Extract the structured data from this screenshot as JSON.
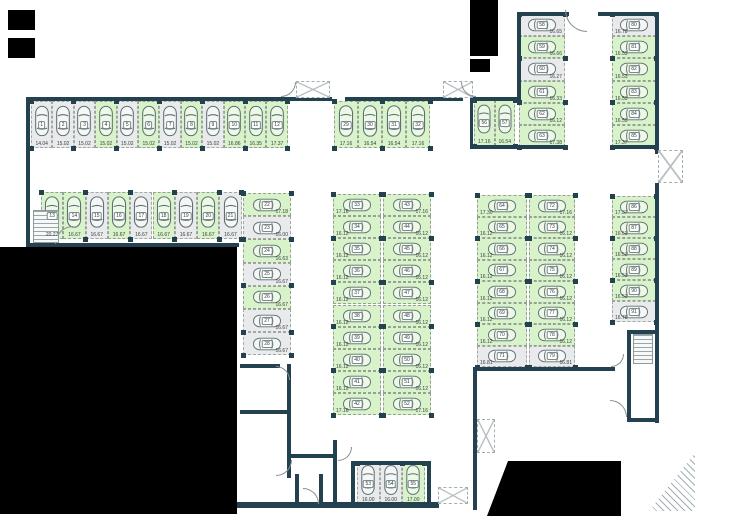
{
  "plan": {
    "title": "parking-garage-floor-plan",
    "colors": {
      "wall": "#24414f",
      "free": "#d8f2ca",
      "occupied": "#e9eaeb",
      "dash": "#97a097",
      "car_outline": "#5f6f72",
      "mask": "#000000"
    },
    "canvas": {
      "w": 754,
      "h": 522
    },
    "groups": [
      {
        "id": "row-01-12",
        "dir": "row",
        "x": 31,
        "y": 101,
        "sw": 21.4,
        "sh": 47,
        "areaPos": "center",
        "spaces": [
          {
            "n": "1",
            "area": "14.04",
            "state": "occupied"
          },
          {
            "n": "2",
            "area": "15.02",
            "state": "occupied"
          },
          {
            "n": "3",
            "area": "15.02",
            "state": "occupied"
          },
          {
            "n": "4",
            "area": "15.02",
            "state": "free"
          },
          {
            "n": "5",
            "area": "15.02",
            "state": "occupied"
          },
          {
            "n": "6",
            "area": "15.02",
            "state": "free"
          },
          {
            "n": "7",
            "area": "15.02",
            "state": "occupied"
          },
          {
            "n": "8",
            "area": "15.02",
            "state": "free"
          },
          {
            "n": "9",
            "area": "15.02",
            "state": "occupied"
          },
          {
            "n": "10",
            "area": "16.86",
            "state": "free"
          },
          {
            "n": "11",
            "area": "16.35",
            "state": "free"
          },
          {
            "n": "12",
            "area": "17.37",
            "state": "free"
          }
        ]
      },
      {
        "id": "row-13-21",
        "dir": "row",
        "x": 41,
        "y": 192,
        "sw": 22.3,
        "sh": 47,
        "areaPos": "center",
        "spaces": [
          {
            "n": "13",
            "area": "20.27",
            "state": "free"
          },
          {
            "n": "14",
            "area": "16.67",
            "state": "free"
          },
          {
            "n": "15",
            "area": "16.67",
            "state": "occupied"
          },
          {
            "n": "16",
            "area": "16.67",
            "state": "free"
          },
          {
            "n": "17",
            "area": "16.67",
            "state": "occupied"
          },
          {
            "n": "18",
            "area": "16.67",
            "state": "free"
          },
          {
            "n": "19",
            "area": "16.67",
            "state": "occupied"
          },
          {
            "n": "20",
            "area": "16.67",
            "state": "free"
          },
          {
            "n": "21",
            "area": "16.67",
            "state": "occupied"
          }
        ]
      },
      {
        "id": "col-22-28",
        "dir": "col",
        "x": 243,
        "y": 193,
        "sw": 48,
        "sh": 23.2,
        "areaPos": "right",
        "spaces": [
          {
            "n": "22",
            "area": "17.18",
            "state": "free"
          },
          {
            "n": "23",
            "area": "16.00",
            "state": "occupied"
          },
          {
            "n": "24",
            "area": "16.63",
            "state": "free"
          },
          {
            "n": "25",
            "area": "16.67",
            "state": "occupied"
          },
          {
            "n": "26",
            "area": "16.67",
            "state": "free"
          },
          {
            "n": "27",
            "area": "16.67",
            "state": "occupied"
          },
          {
            "n": "28",
            "area": "16.67",
            "state": "occupied"
          }
        ]
      },
      {
        "id": "row-29-32",
        "dir": "row",
        "x": 334,
        "y": 101,
        "sw": 24,
        "sh": 47,
        "areaPos": "center",
        "spaces": [
          {
            "n": "29",
            "area": "17.16",
            "state": "free"
          },
          {
            "n": "30",
            "area": "16.54",
            "state": "free"
          },
          {
            "n": "31",
            "area": "16.54",
            "state": "free"
          },
          {
            "n": "32",
            "area": "17.16",
            "state": "free"
          }
        ]
      },
      {
        "id": "col-33-42",
        "dir": "col",
        "x": 333,
        "y": 194,
        "sw": 48,
        "sh": 22.1,
        "areaPos": "left",
        "spaces": [
          {
            "n": "33",
            "area": "17.16",
            "state": "free"
          },
          {
            "n": "34",
            "area": "16.12",
            "state": "free"
          },
          {
            "n": "35",
            "area": "16.12",
            "state": "free"
          },
          {
            "n": "36",
            "area": "16.12",
            "state": "free"
          },
          {
            "n": "37",
            "area": "16.12",
            "state": "free"
          },
          {
            "n": "38",
            "area": "16.12",
            "state": "free"
          },
          {
            "n": "39",
            "area": "16.12",
            "state": "free"
          },
          {
            "n": "40",
            "area": "16.12",
            "state": "free"
          },
          {
            "n": "41",
            "area": "16.12",
            "state": "free"
          },
          {
            "n": "42",
            "area": "17.16",
            "state": "free"
          }
        ]
      },
      {
        "id": "col-43-52",
        "dir": "col",
        "x": 383,
        "y": 194,
        "sw": 48,
        "sh": 22.1,
        "areaPos": "right",
        "spaces": [
          {
            "n": "43",
            "area": "17.16",
            "state": "free"
          },
          {
            "n": "44",
            "area": "16.12",
            "state": "free"
          },
          {
            "n": "45",
            "area": "16.12",
            "state": "free"
          },
          {
            "n": "46",
            "area": "16.12",
            "state": "free"
          },
          {
            "n": "47",
            "area": "16.12",
            "state": "free"
          },
          {
            "n": "48",
            "area": "16.12",
            "state": "free"
          },
          {
            "n": "49",
            "area": "16.12",
            "state": "free"
          },
          {
            "n": "50",
            "area": "16.12",
            "state": "free"
          },
          {
            "n": "51",
            "area": "16.12",
            "state": "free"
          },
          {
            "n": "52",
            "area": "17.16",
            "state": "free"
          }
        ]
      },
      {
        "id": "row-53-55",
        "dir": "row",
        "x": 357,
        "y": 463,
        "sw": 22.5,
        "sh": 41,
        "areaPos": "center",
        "spaces": [
          {
            "n": "53",
            "area": "16.00",
            "state": "occupied"
          },
          {
            "n": "54",
            "area": "16.00",
            "state": "occupied"
          },
          {
            "n": "55",
            "area": "17.00",
            "state": "free"
          }
        ]
      },
      {
        "id": "row-56-57",
        "dir": "row",
        "x": 474,
        "y": 100,
        "sw": 20.5,
        "sh": 46,
        "areaPos": "center",
        "spaces": [
          {
            "n": "56",
            "area": "17.16",
            "state": "free"
          },
          {
            "n": "57",
            "area": "16.54",
            "state": "free"
          }
        ]
      },
      {
        "id": "col-58-63",
        "dir": "col",
        "x": 519,
        "y": 14,
        "sw": 46,
        "sh": 22.2,
        "areaPos": "right",
        "spaces": [
          {
            "n": "58",
            "area": "16.65",
            "state": "occupied"
          },
          {
            "n": "59",
            "area": "16.66",
            "state": "free"
          },
          {
            "n": "60",
            "area": "16.27",
            "state": "occupied"
          },
          {
            "n": "61",
            "area": "16.33",
            "state": "free"
          },
          {
            "n": "62",
            "area": "16.12",
            "state": "free"
          },
          {
            "n": "63",
            "area": "17.38",
            "state": "free"
          }
        ]
      },
      {
        "id": "col-80-85",
        "dir": "col",
        "x": 612,
        "y": 14,
        "sw": 44,
        "sh": 22.2,
        "areaPos": "left",
        "spaces": [
          {
            "n": "80",
            "area": "16.78",
            "state": "occupied"
          },
          {
            "n": "81",
            "area": "16.53",
            "state": "free"
          },
          {
            "n": "82",
            "area": "16.53",
            "state": "free"
          },
          {
            "n": "83",
            "area": "16.53",
            "state": "free"
          },
          {
            "n": "84",
            "area": "16.53",
            "state": "free"
          },
          {
            "n": "85",
            "area": "17.37",
            "state": "free"
          }
        ]
      },
      {
        "id": "col-64-71",
        "dir": "col",
        "x": 477,
        "y": 195,
        "sw": 50,
        "sh": 21.5,
        "areaPos": "left",
        "spaces": [
          {
            "n": "64",
            "area": "17.30",
            "state": "free"
          },
          {
            "n": "65",
            "area": "16.12",
            "state": "free"
          },
          {
            "n": "66",
            "area": "16.12",
            "state": "free"
          },
          {
            "n": "67",
            "area": "16.12",
            "state": "free"
          },
          {
            "n": "68",
            "area": "16.12",
            "state": "free"
          },
          {
            "n": "69",
            "area": "16.12",
            "state": "free"
          },
          {
            "n": "70",
            "area": "16.12",
            "state": "free"
          },
          {
            "n": "71",
            "area": "16.81",
            "state": "occupied"
          }
        ]
      },
      {
        "id": "col-72-79",
        "dir": "col",
        "x": 529,
        "y": 195,
        "sw": 46,
        "sh": 21.5,
        "areaPos": "right",
        "spaces": [
          {
            "n": "72",
            "area": "17.16",
            "state": "free"
          },
          {
            "n": "73",
            "area": "16.12",
            "state": "free"
          },
          {
            "n": "74",
            "area": "16.12",
            "state": "free"
          },
          {
            "n": "75",
            "area": "16.12",
            "state": "free"
          },
          {
            "n": "76",
            "area": "16.12",
            "state": "free"
          },
          {
            "n": "77",
            "area": "16.12",
            "state": "free"
          },
          {
            "n": "78",
            "area": "16.12",
            "state": "free"
          },
          {
            "n": "79",
            "area": "16.81",
            "state": "occupied"
          }
        ]
      },
      {
        "id": "col-86-91",
        "dir": "col",
        "x": 612,
        "y": 196,
        "sw": 44,
        "sh": 21,
        "areaPos": "left",
        "spaces": [
          {
            "n": "86",
            "area": "17.37",
            "state": "free"
          },
          {
            "n": "87",
            "area": "16.53",
            "state": "free"
          },
          {
            "n": "88",
            "area": "16.53",
            "state": "free"
          },
          {
            "n": "89",
            "area": "16.53",
            "state": "free"
          },
          {
            "n": "90",
            "area": "16.53",
            "state": "free"
          },
          {
            "n": "91",
            "area": "16.78",
            "state": "occupied"
          }
        ]
      }
    ],
    "walls": [
      [
        26,
        97,
        306,
        4
      ],
      [
        345,
        97,
        118,
        4
      ],
      [
        26,
        97,
        4,
        150
      ],
      [
        26,
        243,
        213,
        4
      ],
      [
        470,
        97,
        51,
        4
      ],
      [
        470,
        97,
        3,
        52
      ],
      [
        470,
        145,
        51,
        4
      ],
      [
        517,
        12,
        4,
        90
      ],
      [
        517,
        12,
        52,
        4
      ],
      [
        598,
        12,
        61,
        4
      ],
      [
        655,
        12,
        4,
        142
      ],
      [
        517,
        145,
        50,
        4
      ],
      [
        611,
        145,
        48,
        4
      ],
      [
        655,
        183,
        4,
        240
      ],
      [
        473,
        367,
        142,
        4
      ],
      [
        473,
        367,
        4,
        143
      ],
      [
        627,
        330,
        4,
        92
      ],
      [
        627,
        330,
        32,
        4
      ],
      [
        627,
        418,
        32,
        4
      ],
      [
        333,
        440,
        4,
        68
      ],
      [
        351,
        461,
        80,
        4
      ],
      [
        351,
        461,
        4,
        46
      ],
      [
        427,
        461,
        4,
        46
      ],
      [
        337,
        502,
        102,
        6
      ],
      [
        240,
        364,
        40,
        4
      ],
      [
        240,
        410,
        51,
        4
      ],
      [
        287,
        364,
        4,
        114
      ],
      [
        287,
        454,
        46,
        4
      ],
      [
        295,
        474,
        4,
        30
      ],
      [
        319,
        474,
        4,
        30
      ],
      [
        237,
        502,
        100,
        6
      ]
    ],
    "vents": [
      [
        296,
        81,
        34,
        17
      ],
      [
        443,
        81,
        30,
        17
      ],
      [
        658,
        150,
        25,
        33
      ],
      [
        477,
        419,
        18,
        34
      ],
      [
        438,
        487,
        30,
        17
      ]
    ],
    "doors": [
      [
        281,
        82,
        15,
        "br"
      ],
      [
        461,
        82,
        15,
        "bl"
      ],
      [
        565,
        10,
        22,
        "bl"
      ],
      [
        55,
        226,
        18,
        "tl"
      ],
      [
        276,
        366,
        14,
        "tr"
      ],
      [
        276,
        460,
        16,
        "br"
      ],
      [
        303,
        488,
        16,
        "tr"
      ],
      [
        338,
        447,
        14,
        "br"
      ],
      [
        610,
        400,
        17,
        "tr"
      ],
      [
        611,
        354,
        13,
        "br"
      ]
    ],
    "stairs": [
      [
        33,
        210,
        26,
        33
      ],
      [
        633,
        334,
        20,
        30
      ]
    ],
    "hatches": [
      [
        649,
        453,
        46,
        58
      ]
    ],
    "masks": {
      "rects": [
        [
          0,
          247,
          237,
          267
        ],
        [
          8,
          10,
          27,
          20
        ],
        [
          8,
          38,
          27,
          20
        ],
        [
          470,
          0,
          28,
          56
        ],
        [
          470,
          59,
          20,
          13
        ]
      ],
      "polys": [
        "polygon(508px 461px, 621px 461px, 621px 516px, 487px 516px)"
      ]
    }
  }
}
